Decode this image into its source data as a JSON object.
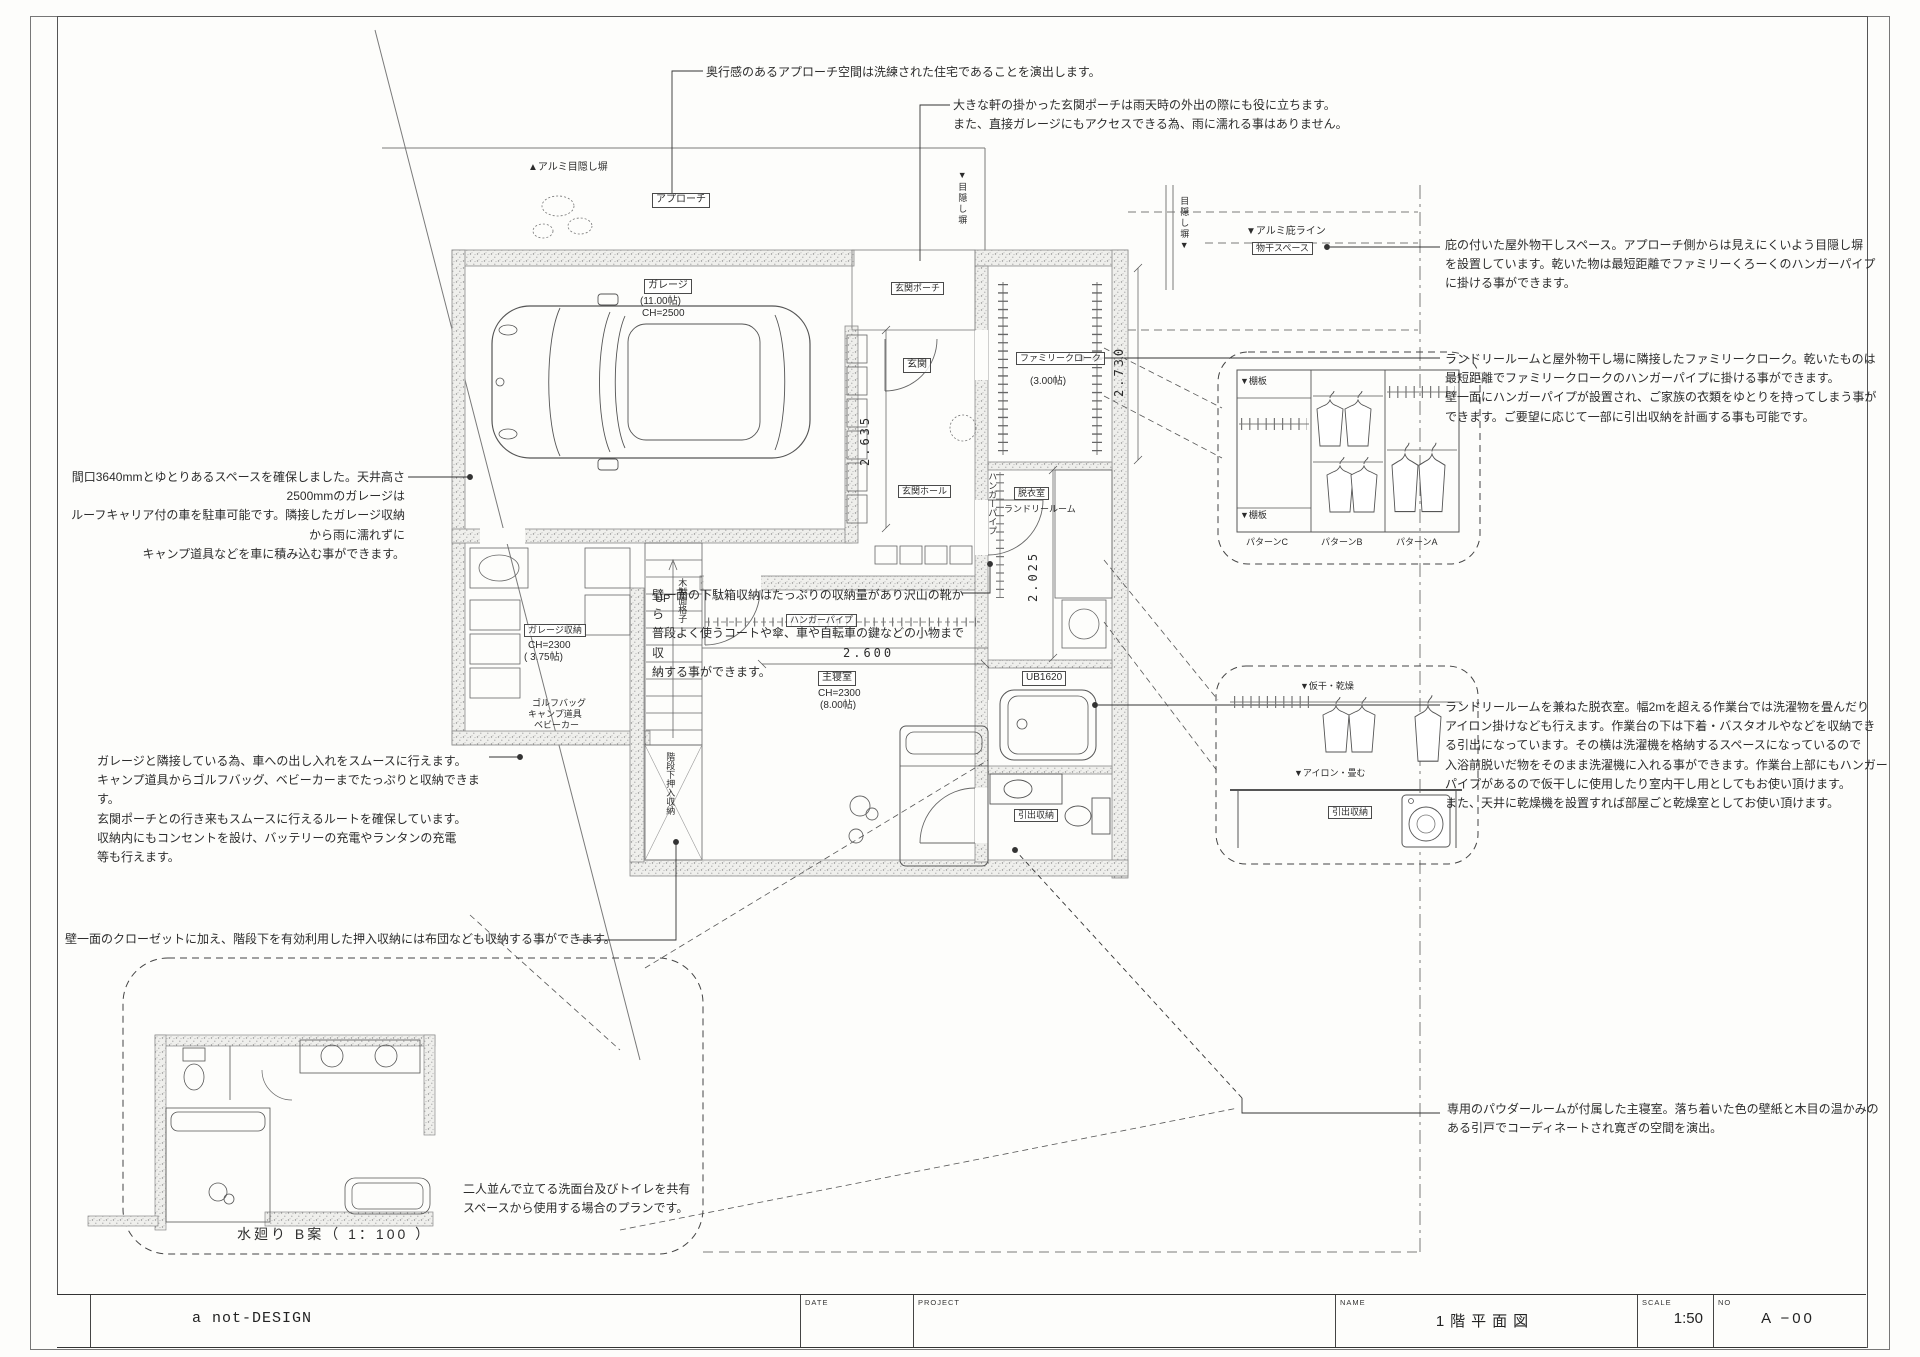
{
  "sheet": {
    "bg": "#fdfdfb",
    "line_color": "#4a4a4a",
    "stipple_color": "#9a9a9a"
  },
  "title_block": {
    "company": "a not-DESIGN",
    "date_label": "DATE",
    "project_label": "PROJECT",
    "name_label": "NAME",
    "name_value": "1階平面図",
    "scale_label": "SCALE",
    "scale_value": "1:50",
    "no_label": "NO",
    "no_value": "A −00"
  },
  "annotations": {
    "approach": "奥行感のあるアプローチ空間は洗練された住宅であることを演出します。",
    "porch": "大きな軒の掛かった玄関ポーチは雨天時の外出の際にも役に立ちます。\nまた、直接ガレージにもアクセスできる為、雨に濡れる事はありません。",
    "drying_space": "庇の付いた屋外物干しスペース。アプローチ側からは見えにくいよう目隠し塀\nを設置しています。乾いた物は最短距離でファミリーくろーくのハンガーパイプ\nに掛ける事ができます。",
    "family_cloak": "ランドリールームと屋外物干し場に隣接したファミリークローク。乾いたものは\n最短距離でファミリークロークのハンガーパイプに掛ける事ができます。\n壁一面にハンガーパイプが設置され、ご家族の衣類をゆとりを持ってしまう事が\nできます。ご要望に応じて一部に引出収納を計画する事も可能です。",
    "garage": "間口3640mmとゆとりあるスペースを確保しました。天井高さ2500mmのガレージは\nルーフキャリア付の車を駐車可能です。隣接したガレージ収納から雨に濡れずに\nキャンプ道具などを車に積み込む事ができます。",
    "shoe_storage": "壁一面の下駄箱収納はたっぷりの収納量があり沢山の靴から\n普段よく使うコートや傘、車や自転車の鍵などの小物まで収\n納する事ができます。",
    "garage_storage": "ガレージと隣接している為、車への出し入れをスムースに行えます。\nキャンプ道具からゴルフバッグ、ベビーカーまでたっぷりと収納できます。\n玄関ポーチとの行き来もスムースに行えるルートを確保しています。\n収納内にもコンセントを設け、バッテリーの充電やランタンの充電\n等も行えます。",
    "laundry": "ランドリールームを兼ねた脱衣室。幅2mを超える作業台では洗濯物を畳んだり\nアイロン掛けなども行えます。作業台の下は下着・バスタオルやなどを収納でき\nる引出になっています。その横は洗濯機を格納するスペースになっているので\n入浴前脱いだ物をそのまま洗濯機に入れる事ができます。作業台上部にもハンガー\nパイプがあるので仮干しに使用したり室内干し用としてもお使い頂けます。\nまた、天井に乾燥機を設置すれば部屋ごと乾燥室としてお使い頂けます。",
    "closet": "壁一面のクローゼットに加え、階段下を有効利用した押入収納には布団なども収納する事ができます。",
    "bedroom": "専用のパウダールームが付属した主寝室。落ち着いた色の壁紙と木目の温かみの\nある引戸でコーディネートされ寛ぎの空間を演出。"
  },
  "plan_labels": {
    "alumi_fence_top": "▲アルミ目隠し塀",
    "approach": "アプローチ",
    "alumi_hisashi": "▼アルミ庇ライン",
    "monohoshi": "物干スペース",
    "mekakushi_right": "▼目隠し塀",
    "mekakushi_far_right": "目隠し塀▼",
    "garage": "ガレージ",
    "garage_size": "(11.00帖)",
    "garage_ch": "CH=2500",
    "porch": "玄関ポーチ",
    "genkan": "玄関",
    "genkan_hall": "玄関ホール",
    "family_cloak": "ファミリークローク",
    "family_cloak_size": "(3.00帖)",
    "datsuishitsu": "脱衣室",
    "laundry_room": "ランドリールーム",
    "hanger_pipe_laundry": "ハンガーパイプ",
    "hanger_pipe_bedroom": "ハンガーパイプ",
    "up": "UP",
    "garage_storage": "ガレージ収納",
    "garage_storage_ch": "CH=2300",
    "garage_storage_size": "( 3.75帖)",
    "golf_bag": "ゴルフバッグ",
    "camp_gear": "キャンプ道具",
    "baby_car": "ベビーカー",
    "bedroom": "主寝室",
    "bedroom_ch": "CH=2300",
    "bedroom_size": "(8.00帖)",
    "ub": "UB1620",
    "stairs_storage": "階段下押入収納",
    "wood_lattice": "木製面格子",
    "drawer_storage": "引出収納",
    "dims": {
      "d2730": "2.730",
      "d2635": "2.635",
      "d2025": "2.025",
      "d2600": "2.600"
    }
  },
  "detail_closet": {
    "shelf_top": "▼棚板",
    "shelf_bottom": "▼棚板",
    "pattern_c": "パターンC",
    "pattern_b": "パターンB",
    "pattern_a": "パターンA"
  },
  "detail_laundry": {
    "kariboshi": "▼仮干・乾燥",
    "iron": "▼アイロン・畳む",
    "drawer_storage": "引出収納"
  },
  "inset": {
    "note": "二人並んで立てる洗面台及びトイレを共有\nスペースから使用する場合のプランです。",
    "caption": "水廻り B案（ 1：100 ）"
  }
}
